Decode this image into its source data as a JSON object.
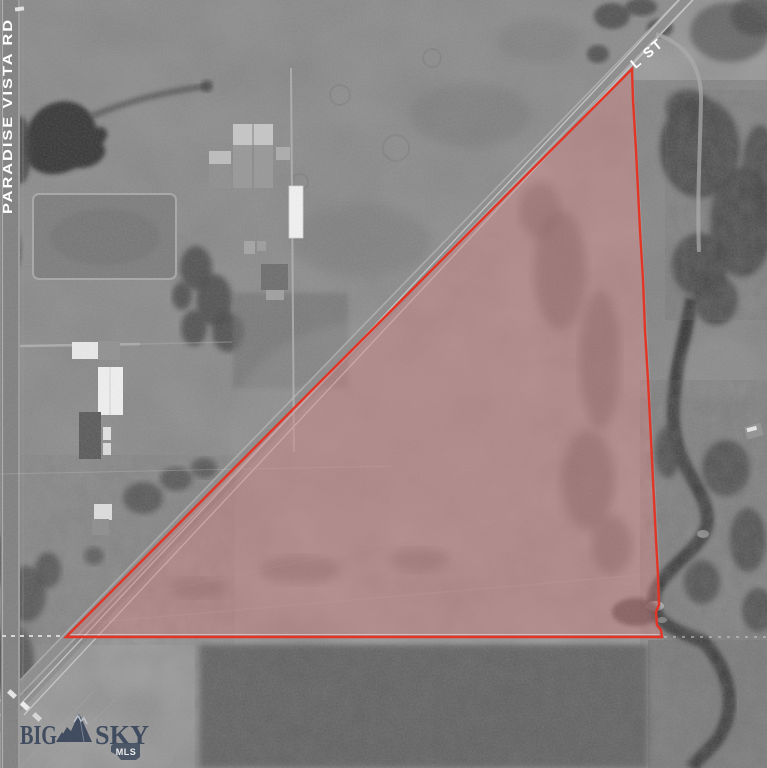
{
  "map": {
    "type": "aerial-parcel-view",
    "road_labels": {
      "left_vertical": "PARADISE VISTA RD",
      "top_right_diagonal": "L ST"
    },
    "parcel_overlay": {
      "shape": "triangular-parcel-boundary",
      "boundary_color": "#e23526",
      "fill_color": "rgba(214,118,118,0.38)"
    },
    "watermark": {
      "word1": "BIG",
      "word2": "SKY",
      "badge_label": "MLS",
      "text_color": "#2d3b53",
      "badge_color": "#36445a"
    }
  }
}
